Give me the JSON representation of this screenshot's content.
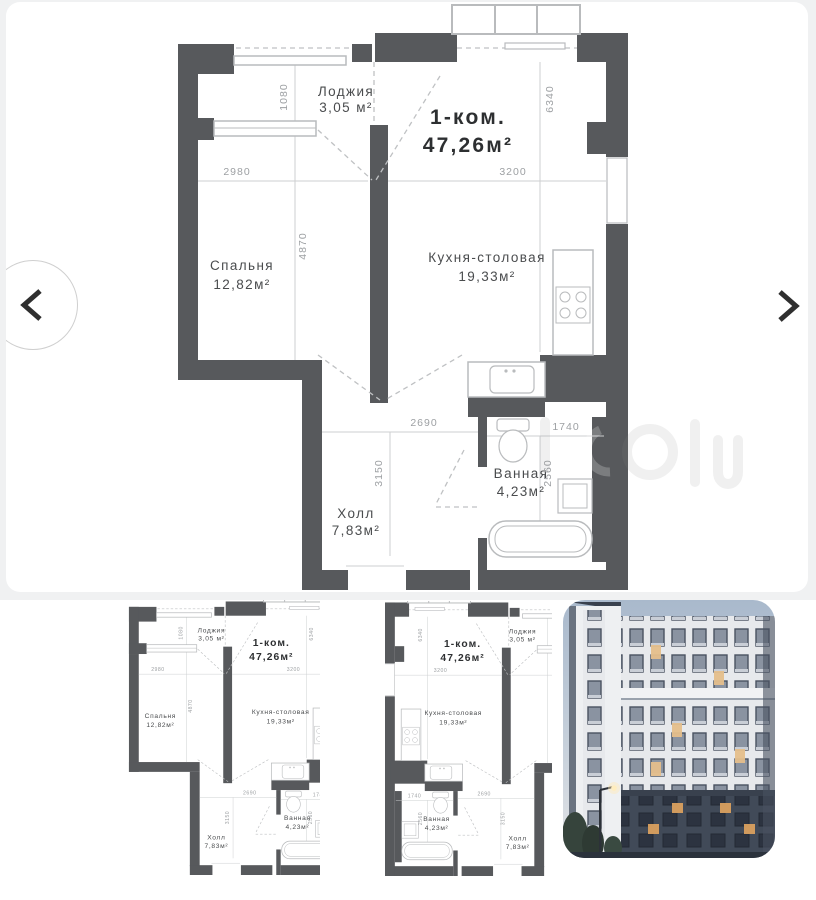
{
  "plan": {
    "type_label": "1-ком.",
    "area_label": "47,26м²",
    "rooms": {
      "loggia": {
        "name": "Лоджия",
        "area": "3,05 м²"
      },
      "bedroom": {
        "name": "Спальня",
        "area": "12,82м²"
      },
      "kitchen": {
        "name": "Кухня-столовая",
        "area": "19,33м²"
      },
      "hall": {
        "name": "Холл",
        "area": "7,83м²"
      },
      "bath": {
        "name": "Ванная",
        "area": "4,23м²"
      }
    },
    "dims": {
      "loggia_h": "1080",
      "bedroom_w": "2980",
      "bedroom_h": "4870",
      "kitchen_w": "3200",
      "kitchen_h": "6340",
      "hall_w": "2690",
      "hall_h": "3150",
      "bath_w": "1740",
      "bath_h": "2560"
    },
    "colors": {
      "wall": "#57595c",
      "line": "#cdcfd1",
      "dashed": "#bfc1c3",
      "dim_text": "#9da0a3",
      "label_text": "#4a4c4e"
    }
  },
  "carousel": {
    "thumbnails": {
      "first": "floorplan-crop",
      "second": "floorplan-mirrored",
      "third": "building-photo"
    }
  }
}
